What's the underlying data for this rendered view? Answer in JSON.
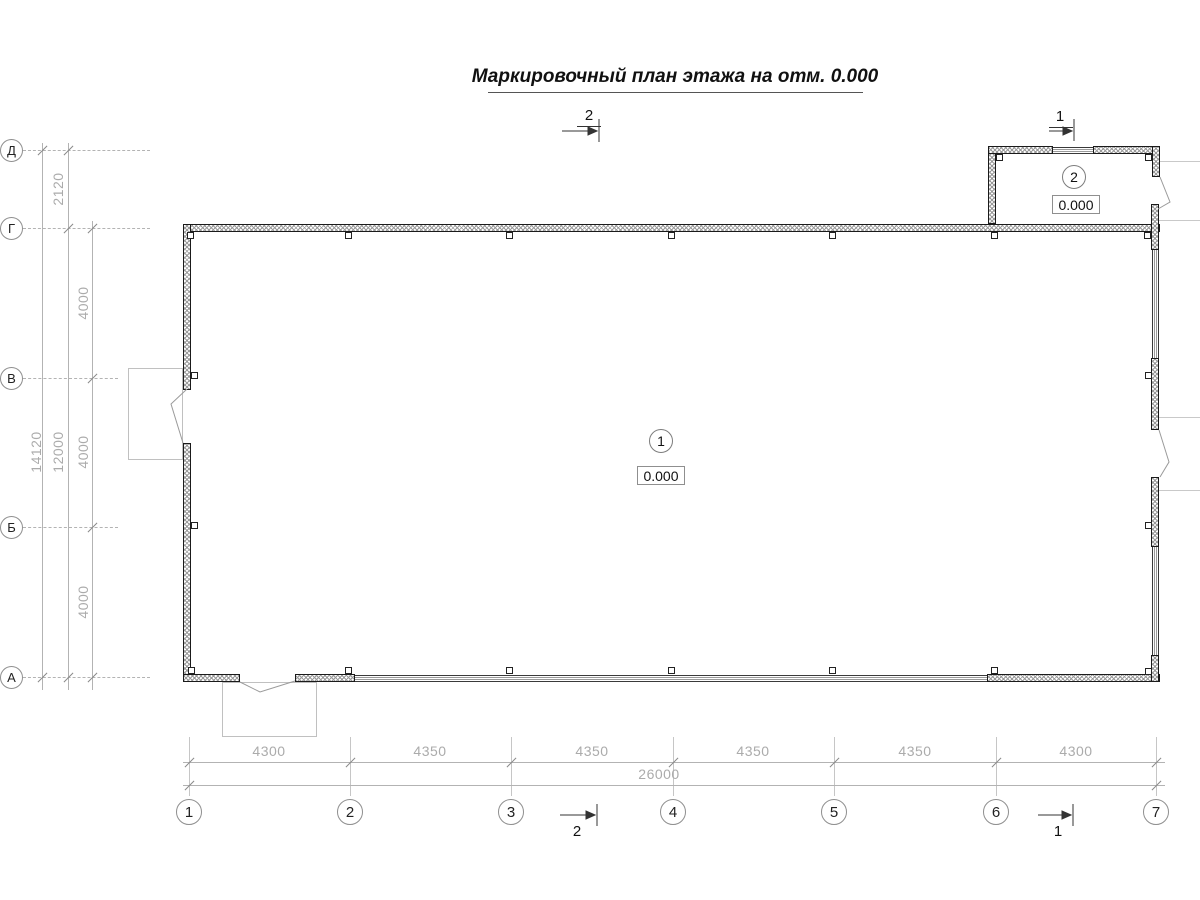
{
  "title": "Маркировочный план этажа на отм. 0.000",
  "axes": {
    "rows": [
      {
        "label": "Д"
      },
      {
        "label": "Г"
      },
      {
        "label": "В"
      },
      {
        "label": "Б"
      },
      {
        "label": "А"
      }
    ],
    "cols": [
      {
        "label": "1"
      },
      {
        "label": "2"
      },
      {
        "label": "3"
      },
      {
        "label": "4"
      },
      {
        "label": "5"
      },
      {
        "label": "6"
      },
      {
        "label": "7"
      }
    ]
  },
  "dimensions": {
    "vertical": {
      "segments": [
        {
          "label": "2120"
        },
        {
          "label": "4000"
        },
        {
          "label": "4000"
        },
        {
          "label": "4000"
        }
      ],
      "subtotal": "12000",
      "total": "14120"
    },
    "horizontal": {
      "segments": [
        {
          "label": "4300"
        },
        {
          "label": "4350"
        },
        {
          "label": "4350"
        },
        {
          "label": "4350"
        },
        {
          "label": "4350"
        },
        {
          "label": "4300"
        }
      ],
      "total": "26000"
    }
  },
  "rooms": [
    {
      "number": "1",
      "elevation": "0.000"
    },
    {
      "number": "2",
      "elevation": "0.000"
    }
  ],
  "sections": {
    "top": [
      {
        "label": "2"
      },
      {
        "label": "1"
      }
    ],
    "bottom": [
      {
        "label": "2"
      },
      {
        "label": "1"
      }
    ]
  }
}
